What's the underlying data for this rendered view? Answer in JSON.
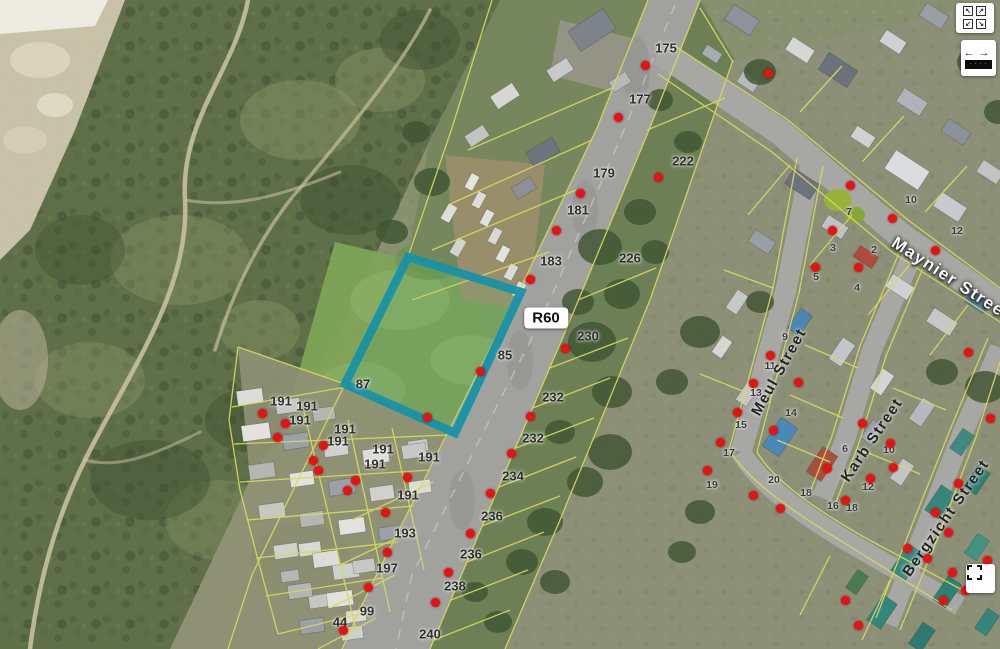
{
  "map": {
    "road_shield": {
      "label": "R60",
      "x": 546,
      "y": 318
    },
    "street_labels": [
      {
        "text": "Maynier Street",
        "x": 951,
        "y": 279,
        "angle": 33,
        "variant": "light"
      },
      {
        "text": "Meul Street",
        "x": 779,
        "y": 372,
        "angle": -61,
        "variant": "dark"
      },
      {
        "text": "Karb Street",
        "x": 872,
        "y": 440,
        "angle": -56,
        "variant": "dark"
      },
      {
        "text": "Bergzicht Street",
        "x": 946,
        "y": 518,
        "angle": -55,
        "variant": "dark"
      }
    ],
    "parcel_labels": [
      {
        "text": "175",
        "x": 666,
        "y": 48
      },
      {
        "text": "177",
        "x": 640,
        "y": 99
      },
      {
        "text": "179",
        "x": 604,
        "y": 173
      },
      {
        "text": "181",
        "x": 578,
        "y": 210
      },
      {
        "text": "183",
        "x": 551,
        "y": 261
      },
      {
        "text": "85",
        "x": 505,
        "y": 355
      },
      {
        "text": "87",
        "x": 363,
        "y": 384
      },
      {
        "text": "191",
        "x": 281,
        "y": 401
      },
      {
        "text": "191",
        "x": 307,
        "y": 406
      },
      {
        "text": "191",
        "x": 300,
        "y": 420
      },
      {
        "text": "191",
        "x": 345,
        "y": 429
      },
      {
        "text": "191",
        "x": 338,
        "y": 441
      },
      {
        "text": "191",
        "x": 383,
        "y": 449
      },
      {
        "text": "191",
        "x": 375,
        "y": 464
      },
      {
        "text": "191",
        "x": 429,
        "y": 457
      },
      {
        "text": "191",
        "x": 408,
        "y": 495
      },
      {
        "text": "193",
        "x": 405,
        "y": 533
      },
      {
        "text": "197",
        "x": 387,
        "y": 568
      },
      {
        "text": "99",
        "x": 367,
        "y": 611
      },
      {
        "text": "44",
        "x": 340,
        "y": 622
      },
      {
        "text": "222",
        "x": 683,
        "y": 161
      },
      {
        "text": "226",
        "x": 630,
        "y": 258
      },
      {
        "text": "230",
        "x": 588,
        "y": 336
      },
      {
        "text": "232",
        "x": 553,
        "y": 397
      },
      {
        "text": "232",
        "x": 533,
        "y": 438
      },
      {
        "text": "234",
        "x": 513,
        "y": 476
      },
      {
        "text": "236",
        "x": 492,
        "y": 516
      },
      {
        "text": "236",
        "x": 471,
        "y": 554
      },
      {
        "text": "238",
        "x": 455,
        "y": 586
      },
      {
        "text": "240",
        "x": 430,
        "y": 634
      }
    ],
    "house_numbers": [
      {
        "text": "7",
        "x": 849,
        "y": 212
      },
      {
        "text": "10",
        "x": 911,
        "y": 200
      },
      {
        "text": "12",
        "x": 957,
        "y": 231
      },
      {
        "text": "3",
        "x": 833,
        "y": 248
      },
      {
        "text": "2",
        "x": 874,
        "y": 250
      },
      {
        "text": "5",
        "x": 816,
        "y": 277
      },
      {
        "text": "4",
        "x": 857,
        "y": 288
      },
      {
        "text": "9",
        "x": 785,
        "y": 337
      },
      {
        "text": "11",
        "x": 770,
        "y": 366
      },
      {
        "text": "13",
        "x": 756,
        "y": 393
      },
      {
        "text": "14",
        "x": 791,
        "y": 413
      },
      {
        "text": "15",
        "x": 741,
        "y": 425
      },
      {
        "text": "17",
        "x": 729,
        "y": 453
      },
      {
        "text": "19",
        "x": 712,
        "y": 485
      },
      {
        "text": "20",
        "x": 774,
        "y": 480
      },
      {
        "text": "18",
        "x": 806,
        "y": 493
      },
      {
        "text": "16",
        "x": 833,
        "y": 506
      },
      {
        "text": "18",
        "x": 852,
        "y": 508
      },
      {
        "text": "12",
        "x": 868,
        "y": 487
      },
      {
        "text": "6",
        "x": 845,
        "y": 449
      },
      {
        "text": "10",
        "x": 889,
        "y": 450
      }
    ],
    "markers": [
      [
        645,
        65
      ],
      [
        618,
        117
      ],
      [
        580,
        193
      ],
      [
        556,
        230
      ],
      [
        530,
        279
      ],
      [
        658,
        177
      ],
      [
        768,
        73
      ],
      [
        480,
        371
      ],
      [
        565,
        348
      ],
      [
        530,
        416
      ],
      [
        511,
        453
      ],
      [
        490,
        493
      ],
      [
        470,
        533
      ],
      [
        448,
        572
      ],
      [
        435,
        602
      ],
      [
        262,
        413
      ],
      [
        285,
        423
      ],
      [
        277,
        437
      ],
      [
        323,
        445
      ],
      [
        313,
        460
      ],
      [
        318,
        470
      ],
      [
        355,
        480
      ],
      [
        347,
        490
      ],
      [
        407,
        477
      ],
      [
        427,
        417
      ],
      [
        385,
        512
      ],
      [
        387,
        552
      ],
      [
        368,
        587
      ],
      [
        343,
        630
      ],
      [
        850,
        185
      ],
      [
        892,
        218
      ],
      [
        832,
        230
      ],
      [
        935,
        250
      ],
      [
        815,
        267
      ],
      [
        858,
        267
      ],
      [
        770,
        355
      ],
      [
        753,
        383
      ],
      [
        798,
        382
      ],
      [
        737,
        412
      ],
      [
        720,
        442
      ],
      [
        773,
        430
      ],
      [
        707,
        470
      ],
      [
        827,
        468
      ],
      [
        753,
        495
      ],
      [
        845,
        500
      ],
      [
        780,
        508
      ],
      [
        862,
        423
      ],
      [
        890,
        443
      ],
      [
        893,
        467
      ],
      [
        870,
        478
      ],
      [
        958,
        483
      ],
      [
        935,
        512
      ],
      [
        948,
        532
      ],
      [
        907,
        548
      ],
      [
        927,
        558
      ],
      [
        968,
        352
      ],
      [
        990,
        418
      ],
      [
        952,
        572
      ],
      [
        987,
        560
      ],
      [
        965,
        590
      ],
      [
        943,
        600
      ],
      [
        845,
        600
      ],
      [
        858,
        625
      ]
    ],
    "highlight_parcel": {
      "points": "408,257 521,292 455,433 345,384",
      "stroke": "#1892a8"
    }
  },
  "controls": {
    "pan_grid": {
      "label": "pan directions",
      "glyphs": [
        "↖",
        "↗",
        "↙",
        "↘"
      ]
    },
    "measure": {
      "label": "measure scale",
      "left_arrow": "←",
      "right_arrow": "→",
      "bar_text": "· · · ·"
    },
    "extent": {
      "label": "zoom to extent"
    }
  },
  "colors": {
    "highlight": "#1892a8",
    "marker": "#e81212",
    "cadastral": "#d9d95c"
  }
}
